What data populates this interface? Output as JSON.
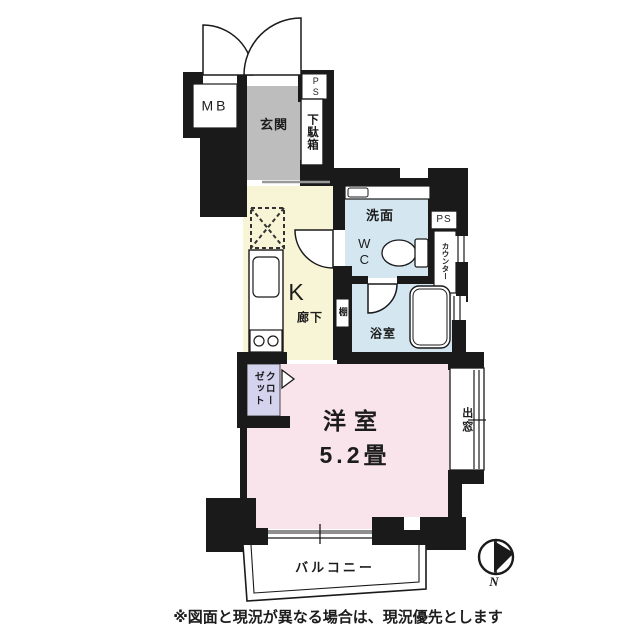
{
  "floorplan": {
    "labels": {
      "meter_box": "MB",
      "pipe_space_top": "PS",
      "entrance": "玄関",
      "shoe_cabinet": "下駄箱",
      "washroom": "洗面",
      "toilet": "WC",
      "pipe_space_right": "PS",
      "counter": "カウンター",
      "kitchen": "K",
      "hallway": "廊下",
      "shelf": "棚",
      "bathroom": "浴室",
      "closet_col_right": "クロー",
      "closet_col_left": "ゼット",
      "western_room": "洋室",
      "western_room_size": "5.2畳",
      "bay_window": "出窓",
      "balcony": "バルコニー",
      "compass_north": "N"
    },
    "footnote": "※図面と現況が異なる場合は、現況優先とします",
    "colors": {
      "wall": "#1a1a1a",
      "entrance_floor": "#bdbdbd",
      "kitchen_floor": "#f8f4d6",
      "wet_area_floor": "#d4e7f1",
      "room_floor": "#f9e4ec",
      "closet_floor": "#d3d3ee",
      "sliding_door": "#8f8f8f"
    }
  }
}
